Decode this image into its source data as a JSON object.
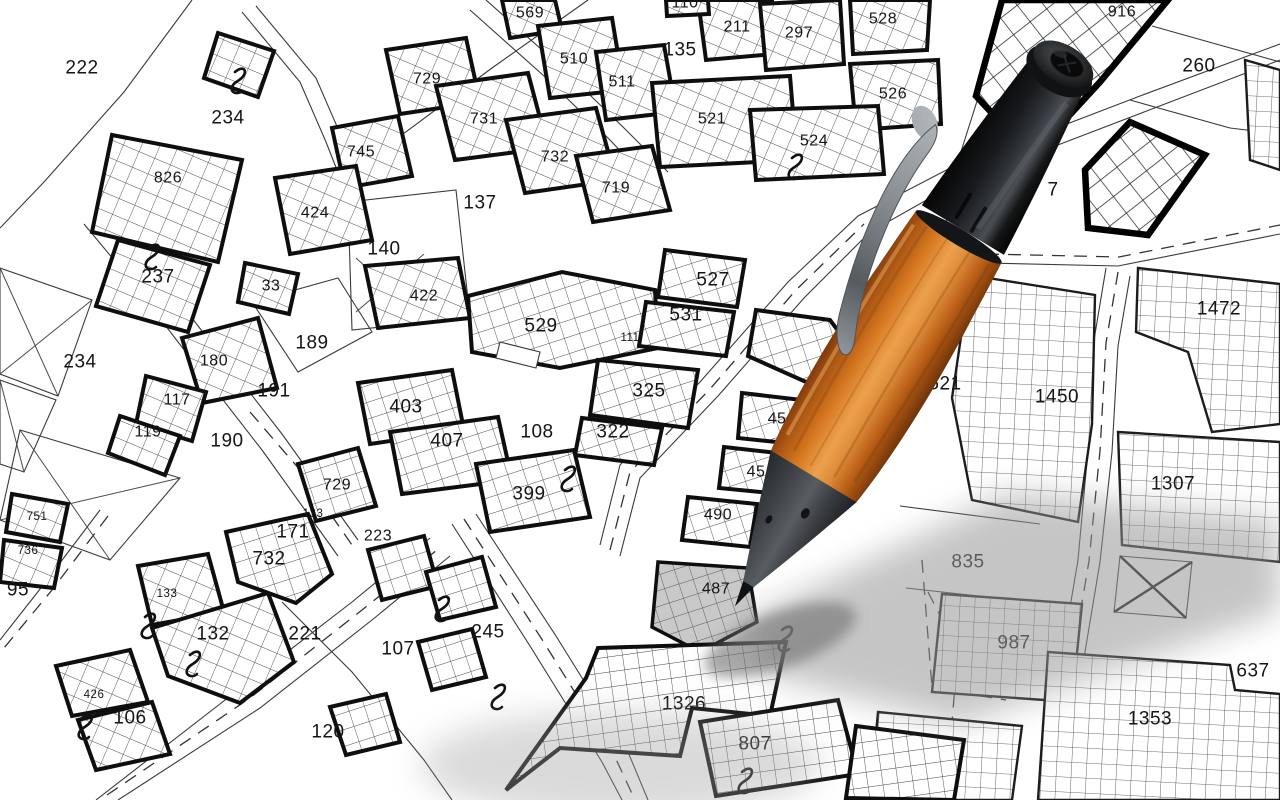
{
  "map": {
    "type": "cadastral-parcel-map",
    "background_color": "#ffffff",
    "line_color": "#1c1c1c",
    "hatch_color": "#4a4a4a",
    "selected_parcel": "487",
    "selected_fill": "#c9c9c9",
    "parcels": [
      {
        "label": "222",
        "x": 82,
        "y": 68,
        "size": "lg"
      },
      {
        "label": "234",
        "x": 228,
        "y": 118,
        "size": "lg"
      },
      {
        "label": "826",
        "x": 168,
        "y": 178,
        "size": "md"
      },
      {
        "label": "745",
        "x": 361,
        "y": 152,
        "size": "md"
      },
      {
        "label": "729",
        "x": 427,
        "y": 79,
        "size": "md"
      },
      {
        "label": "731",
        "x": 484,
        "y": 119,
        "size": "md"
      },
      {
        "label": "732",
        "x": 555,
        "y": 157,
        "size": "md"
      },
      {
        "label": "719",
        "x": 616,
        "y": 188,
        "size": "md"
      },
      {
        "label": "137",
        "x": 480,
        "y": 203,
        "size": "lg"
      },
      {
        "label": "424",
        "x": 315,
        "y": 213,
        "size": "md"
      },
      {
        "label": "140",
        "x": 384,
        "y": 249,
        "size": "lg"
      },
      {
        "label": "422",
        "x": 424,
        "y": 296,
        "size": "md"
      },
      {
        "label": "237",
        "x": 158,
        "y": 277,
        "size": "lg"
      },
      {
        "label": "33",
        "x": 271,
        "y": 286,
        "size": "md"
      },
      {
        "label": "569",
        "x": 530,
        "y": 13,
        "size": "md"
      },
      {
        "label": "510",
        "x": 574,
        "y": 59,
        "size": "md"
      },
      {
        "label": "511",
        "x": 622,
        "y": 82,
        "size": "md"
      },
      {
        "label": "135",
        "x": 680,
        "y": 50,
        "size": "lg"
      },
      {
        "label": "110",
        "x": 685,
        "y": 3,
        "size": "md"
      },
      {
        "label": "211",
        "x": 737,
        "y": 27,
        "size": "md"
      },
      {
        "label": "297",
        "x": 799,
        "y": 33,
        "size": "md"
      },
      {
        "label": "528",
        "x": 883,
        "y": 19,
        "size": "md"
      },
      {
        "label": "526",
        "x": 893,
        "y": 94,
        "size": "md"
      },
      {
        "label": "521",
        "x": 712,
        "y": 119,
        "size": "md"
      },
      {
        "label": "524",
        "x": 814,
        "y": 141,
        "size": "md"
      },
      {
        "label": "916",
        "x": 1122,
        "y": 12,
        "size": "md"
      },
      {
        "label": "260",
        "x": 1199,
        "y": 66,
        "size": "lg"
      },
      {
        "label": "7",
        "x": 1053,
        "y": 190,
        "size": "lg"
      },
      {
        "label": "234",
        "x": 80,
        "y": 362,
        "size": "lg"
      },
      {
        "label": "180",
        "x": 214,
        "y": 361,
        "size": "md"
      },
      {
        "label": "117",
        "x": 177,
        "y": 400,
        "size": "md"
      },
      {
        "label": "119",
        "x": 148,
        "y": 432,
        "size": "md"
      },
      {
        "label": "190",
        "x": 227,
        "y": 441,
        "size": "lg"
      },
      {
        "label": "191",
        "x": 274,
        "y": 391,
        "size": "lg"
      },
      {
        "label": "189",
        "x": 312,
        "y": 343,
        "size": "lg"
      },
      {
        "label": "529",
        "x": 541,
        "y": 326,
        "size": "lg"
      },
      {
        "label": "527",
        "x": 713,
        "y": 280,
        "size": "lg"
      },
      {
        "label": "531",
        "x": 686,
        "y": 315,
        "size": "lg"
      },
      {
        "label": "111",
        "x": 630,
        "y": 338,
        "size": "sm"
      },
      {
        "label": "325",
        "x": 649,
        "y": 391,
        "size": "lg"
      },
      {
        "label": "322",
        "x": 613,
        "y": 432,
        "size": "lg"
      },
      {
        "label": "403",
        "x": 406,
        "y": 407,
        "size": "lg"
      },
      {
        "label": "407",
        "x": 447,
        "y": 441,
        "size": "lg"
      },
      {
        "label": "108",
        "x": 537,
        "y": 432,
        "size": "lg"
      },
      {
        "label": "399",
        "x": 529,
        "y": 494,
        "size": "lg"
      },
      {
        "label": "223",
        "x": 378,
        "y": 536,
        "size": "md"
      },
      {
        "label": "729",
        "x": 337,
        "y": 485,
        "size": "md"
      },
      {
        "label": "133",
        "x": 313,
        "y": 514,
        "size": "sm"
      },
      {
        "label": "171",
        "x": 293,
        "y": 532,
        "size": "lg"
      },
      {
        "label": "732",
        "x": 269,
        "y": 559,
        "size": "lg"
      },
      {
        "label": "751",
        "x": 37,
        "y": 517,
        "size": "sm"
      },
      {
        "label": "736",
        "x": 28,
        "y": 551,
        "size": "sm"
      },
      {
        "label": "95",
        "x": 18,
        "y": 590,
        "size": "lg"
      },
      {
        "label": "133",
        "x": 167,
        "y": 594,
        "size": "sm"
      },
      {
        "label": "132",
        "x": 213,
        "y": 634,
        "size": "lg"
      },
      {
        "label": "426",
        "x": 94,
        "y": 695,
        "size": "sm"
      },
      {
        "label": "106",
        "x": 130,
        "y": 718,
        "size": "lg"
      },
      {
        "label": "221",
        "x": 305,
        "y": 634,
        "size": "lg"
      },
      {
        "label": "120",
        "x": 328,
        "y": 732,
        "size": "lg"
      },
      {
        "label": "107",
        "x": 398,
        "y": 649,
        "size": "lg"
      },
      {
        "label": "245",
        "x": 488,
        "y": 632,
        "size": "lg"
      },
      {
        "label": "45",
        "x": 777,
        "y": 419,
        "size": "md"
      },
      {
        "label": "45",
        "x": 756,
        "y": 472,
        "size": "md"
      },
      {
        "label": "490",
        "x": 718,
        "y": 515,
        "size": "md"
      },
      {
        "label": "487",
        "x": 716,
        "y": 589,
        "size": "md"
      },
      {
        "label": "521",
        "x": 945,
        "y": 384,
        "size": "lg"
      },
      {
        "label": "1450",
        "x": 1057,
        "y": 397,
        "size": "lg"
      },
      {
        "label": "1472",
        "x": 1219,
        "y": 309,
        "size": "lg"
      },
      {
        "label": "1307",
        "x": 1173,
        "y": 484,
        "size": "lg"
      },
      {
        "label": "835",
        "x": 968,
        "y": 562,
        "size": "lg"
      },
      {
        "label": "987",
        "x": 1014,
        "y": 643,
        "size": "lg"
      },
      {
        "label": "637",
        "x": 1253,
        "y": 671,
        "size": "lg"
      },
      {
        "label": "1353",
        "x": 1150,
        "y": 719,
        "size": "lg"
      },
      {
        "label": "1326",
        "x": 684,
        "y": 704,
        "size": "lg"
      },
      {
        "label": "807",
        "x": 755,
        "y": 744,
        "size": "lg"
      }
    ],
    "connection_marks": [
      [
        233,
        72
      ],
      [
        147,
        248
      ],
      [
        790,
        158
      ],
      [
        563,
        470
      ],
      [
        437,
        600
      ],
      [
        493,
        688
      ],
      [
        143,
        617
      ],
      [
        80,
        718
      ],
      [
        188,
        655
      ],
      [
        780,
        630
      ],
      [
        740,
        772
      ]
    ]
  },
  "pen": {
    "name": "ballpoint-pen",
    "barrel_color": "#d4761f",
    "barrel_material": "wood",
    "cap_color": "#0b0b0b",
    "grip_color": "#3f4347",
    "clip_color": "#8b9196",
    "shadow_color": "#8f8f8f"
  }
}
